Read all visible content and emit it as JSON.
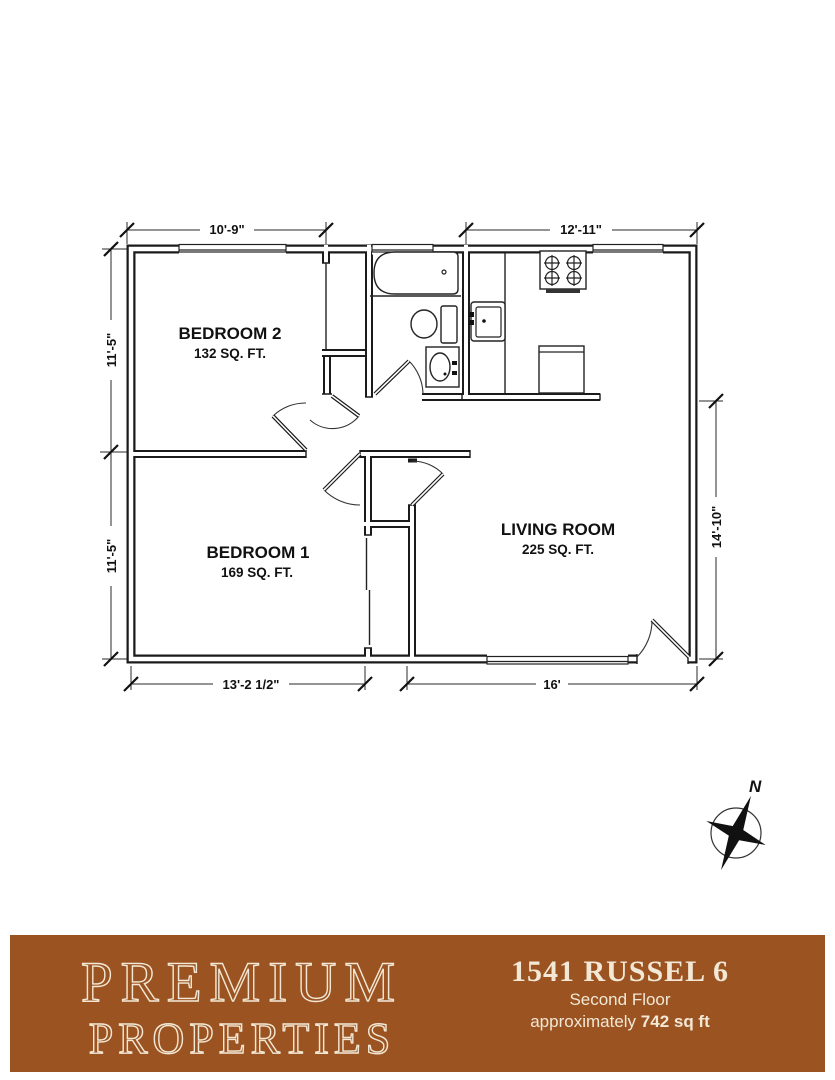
{
  "plan": {
    "rooms": [
      {
        "name": "BEDROOM 2",
        "area": "132 SQ. FT."
      },
      {
        "name": "BEDROOM 1",
        "area": "169 SQ. FT."
      },
      {
        "name": "LIVING ROOM",
        "area": "225 SQ. FT."
      }
    ],
    "dimensions": {
      "top_left": "10'-9\"",
      "top_right": "12'-11\"",
      "left_upper": "11'-5\"",
      "left_lower": "11'-5\"",
      "right_side": "14'-10\"",
      "bottom_left": "13'-2 1/2\"",
      "bottom_right": "16'"
    },
    "compass_label": "N",
    "fixtures": [
      "bathtub",
      "toilet",
      "bathroom-sink",
      "kitchen-sink",
      "stove",
      "refrigerator"
    ],
    "line_color": "#1b1b1b"
  },
  "footer": {
    "brand_line1": "PREMIUM",
    "brand_line2": "PROPERTIES",
    "address": "1541 RUSSEL 6",
    "floor_label": "Second Floor",
    "area_prefix": "approximately ",
    "area_value": "742 sq ft",
    "bar_color": "#9B5321",
    "text_color": "#F2E8D5"
  }
}
